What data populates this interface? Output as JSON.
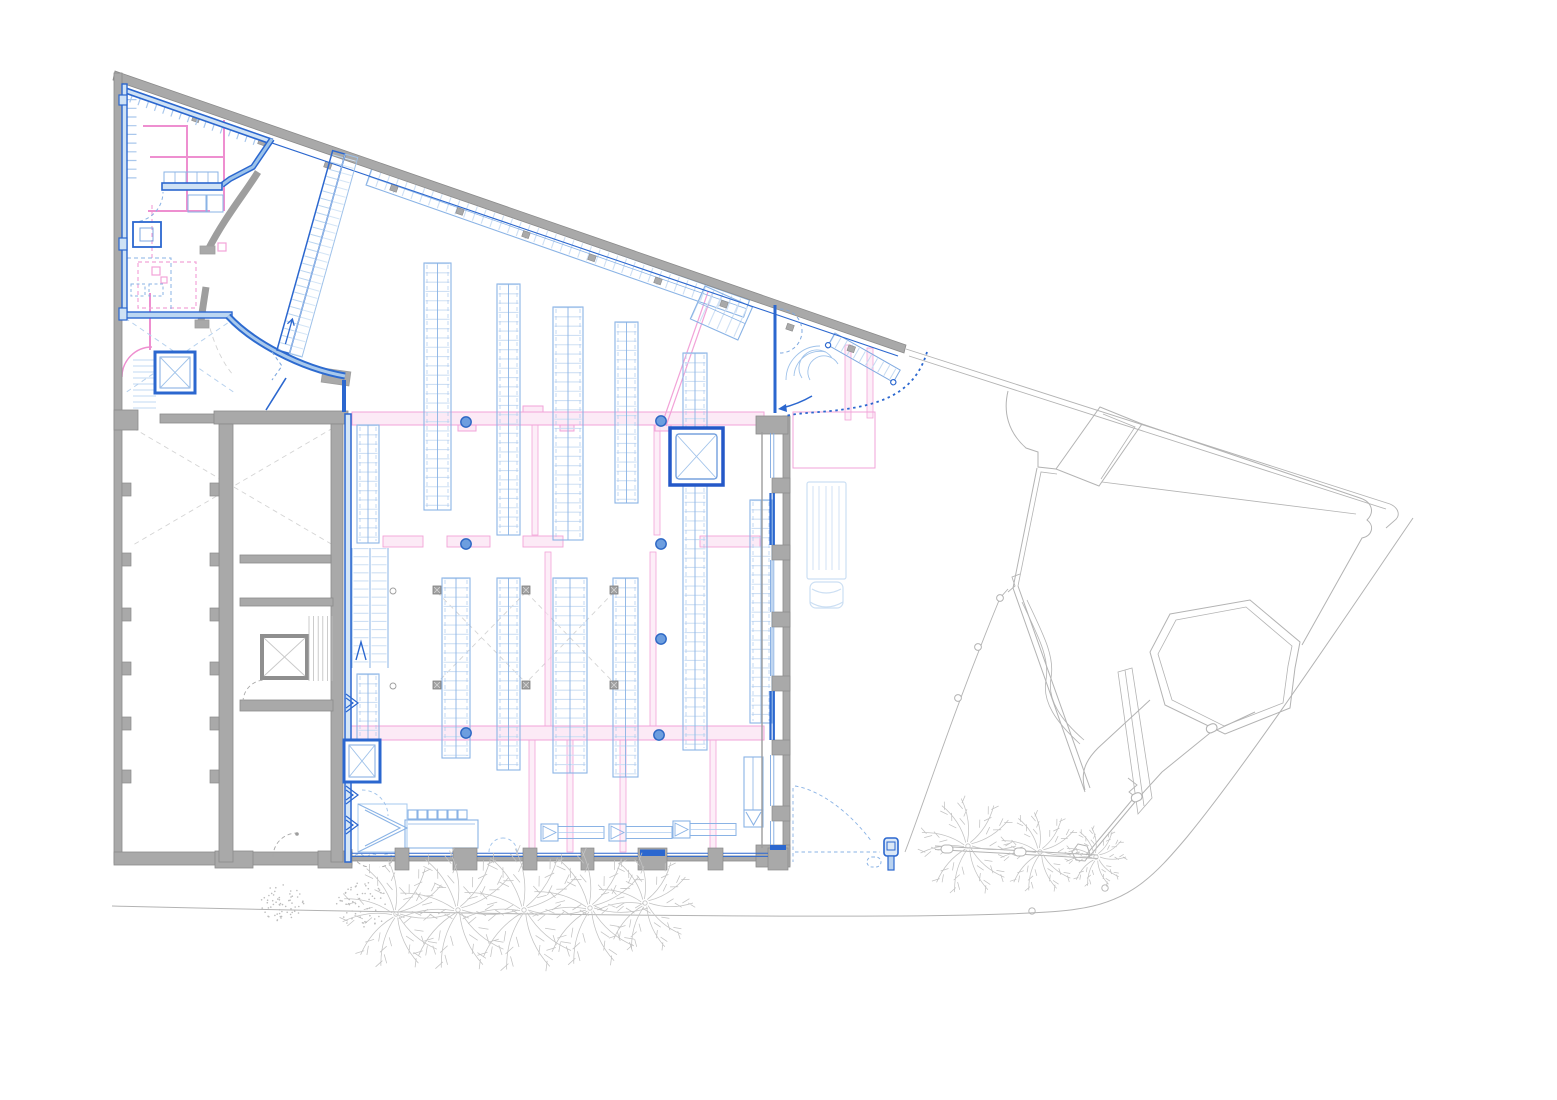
{
  "canvas": {
    "width": 1557,
    "height": 1100
  },
  "palette": {
    "wall_gray": "#a9a9a9",
    "wall_gray_dark": "#8b8b8b",
    "wall_gray_line": "#9d9d9d",
    "site_line": "#b3b3b3",
    "tree": "#c3c3c3",
    "demo_dash": "#d4d4d4",
    "new_blue": "#2b67cf",
    "new_blue_dark": "#1f57bb",
    "band_blue": "#7fa9e0",
    "fixture_blue": "#8ab3e5",
    "fixture_light": "#cfe0f4",
    "fixture_pale": "#dfebf9",
    "truck_blue": "#ccdff3",
    "pink": "#f2a3d8",
    "pink_light": "#fbe3f3",
    "pink_strong": "#ee8fd0",
    "column_fill": "#6d9edf",
    "column_stroke": "#2b66c4"
  },
  "fixtures": {
    "racks_upper": [
      [
        424,
        263,
        27,
        247
      ],
      [
        497,
        284,
        23,
        251
      ],
      [
        553,
        307,
        30,
        233
      ],
      [
        615,
        322,
        23,
        181
      ],
      [
        683,
        353,
        24,
        397
      ],
      [
        750,
        500,
        22,
        223
      ]
    ],
    "racks_lower": [
      [
        442,
        578,
        28,
        180
      ],
      [
        497,
        578,
        23,
        192
      ],
      [
        553,
        578,
        34,
        195
      ],
      [
        613,
        578,
        25,
        199
      ]
    ],
    "side_racks": [
      [
        357,
        425,
        22,
        118
      ],
      [
        357,
        674,
        22,
        100
      ]
    ],
    "diag_racks": [
      {
        "tx": 372,
        "ty": 168,
        "rot": 19.3,
        "len": 400,
        "w": 18
      },
      {
        "tx": 705,
        "ty": 286,
        "rot": 24,
        "len": 52,
        "w": 36
      }
    ],
    "checkouts": [
      [
        541,
        824
      ],
      [
        609,
        824
      ],
      [
        673,
        821
      ]
    ],
    "columns_round": [
      [
        466,
        422
      ],
      [
        661,
        421
      ],
      [
        466,
        544
      ],
      [
        661,
        544
      ],
      [
        661,
        639
      ],
      [
        466,
        733
      ],
      [
        659,
        735
      ]
    ],
    "columns_square": [
      [
        437,
        590
      ],
      [
        526,
        590
      ],
      [
        614,
        590
      ],
      [
        437,
        685
      ],
      [
        526,
        685
      ],
      [
        614,
        685
      ]
    ],
    "small_posts": [
      [
        393,
        591
      ],
      [
        393,
        686
      ]
    ]
  },
  "overhead": {
    "band_a": [
      352,
      412,
      412,
      13
    ],
    "band_c": [
      347,
      726,
      417,
      14
    ],
    "band_b_segments": [
      [
        383,
        40
      ],
      [
        447,
        43
      ],
      [
        523,
        40
      ],
      [
        700,
        60
      ]
    ],
    "verticals": [
      [
        535,
        425,
        110
      ],
      [
        657,
        425,
        110
      ],
      [
        548,
        552,
        174
      ],
      [
        653,
        552,
        174
      ],
      [
        532,
        740,
        112
      ],
      [
        570,
        740,
        112
      ],
      [
        623,
        740,
        112
      ],
      [
        713,
        740,
        112
      ],
      [
        848,
        345,
        75
      ],
      [
        870,
        348,
        70
      ]
    ],
    "diagonal": [
      708,
      292,
      662,
      424
    ]
  },
  "structure": {
    "left_pilasters_y": [
      483,
      553,
      608,
      662,
      717,
      770
    ],
    "mid_pilasters_y": [
      483,
      553,
      608,
      662,
      717,
      770
    ],
    "east_pilasters_y": [
      478,
      545,
      612,
      676,
      740,
      806
    ],
    "east_window_spans": [
      [
        433,
        478
      ],
      [
        493,
        545
      ],
      [
        560,
        612
      ],
      [
        627,
        676
      ],
      [
        691,
        740
      ],
      [
        755,
        806
      ],
      [
        821,
        845
      ]
    ],
    "east_bright_windows": [
      1,
      4
    ],
    "bottom_pilasters": [
      [
        395,
        14
      ],
      [
        453,
        24
      ],
      [
        523,
        14
      ],
      [
        581,
        13
      ],
      [
        638,
        29
      ],
      [
        708,
        15
      ],
      [
        768,
        20
      ]
    ],
    "bottom_window_spans": [
      [
        352,
        395
      ],
      [
        409,
        453
      ],
      [
        477,
        523
      ],
      [
        537,
        581
      ],
      [
        594,
        638
      ],
      [
        667,
        708
      ],
      [
        723,
        768
      ]
    ],
    "top_wall_pier_t": [
      60,
      130,
      200,
      270,
      340,
      410,
      480,
      550,
      620,
      690,
      755
    ]
  },
  "site": {
    "palms": [
      [
        396,
        914,
        54
      ],
      [
        458,
        910,
        60
      ],
      [
        524,
        910,
        62
      ],
      [
        590,
        908,
        58
      ],
      [
        645,
        903,
        48
      ],
      [
        968,
        846,
        48
      ],
      [
        1040,
        852,
        40
      ],
      [
        1096,
        857,
        30
      ]
    ],
    "shrubs": [
      [
        283,
        903,
        22
      ],
      [
        363,
        905,
        27
      ]
    ],
    "fence_posts": [
      [
        958,
        698
      ],
      [
        978,
        647
      ],
      [
        1000,
        598
      ]
    ],
    "rail_posts": [
      [
        941,
        845
      ],
      [
        1014,
        848
      ]
    ],
    "gate_posts": [
      [
        1205,
        727
      ],
      [
        1130,
        796
      ]
    ],
    "road_dots": [
      [
        1032,
        911
      ],
      [
        1105,
        888
      ]
    ]
  }
}
